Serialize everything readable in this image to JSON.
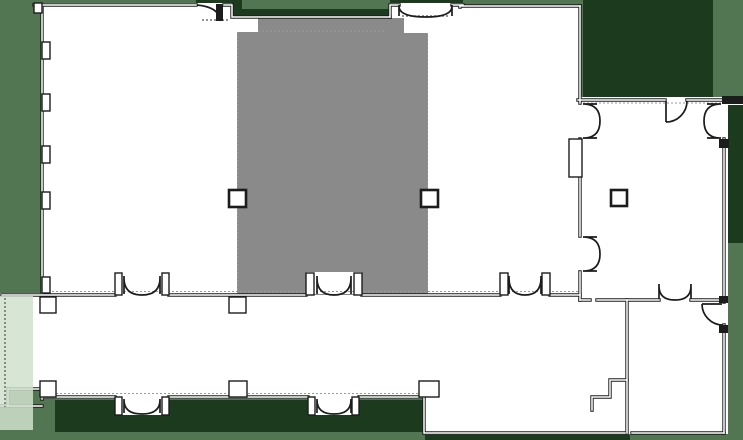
{
  "app": {
    "type": "floor-plan-view",
    "description": "Architectural floor plan with central hall highlighted in gray, door swings, columns and site shadow patches. No text labels visible."
  },
  "canvas": {
    "width": 743,
    "height": 440
  },
  "colors": {
    "background": "#527552",
    "shadow_green": "#1b3a1e",
    "interior": "#ffffff",
    "wall": "#1c1c1c",
    "hairline": "#9a9a9a",
    "highlight": "#8a8a8a",
    "cut_strip": "#cfe0cc",
    "dash": "#555555"
  },
  "shadow_patches": [
    {
      "name": "shadow-top-right-court",
      "x": 583,
      "y": 0,
      "w": 130,
      "h": 97
    },
    {
      "name": "shadow-top-left-door",
      "x": 196,
      "y": 0,
      "w": 46,
      "h": 20
    },
    {
      "name": "shadow-above-hall-wall",
      "x": 232,
      "y": 9,
      "w": 160,
      "h": 8
    },
    {
      "name": "shadow-top-entry-bay",
      "x": 390,
      "y": 0,
      "w": 73,
      "h": 5
    },
    {
      "name": "shadow-right-strip",
      "x": 728,
      "y": 97,
      "w": 15,
      "h": 146
    },
    {
      "name": "shadow-bottom-terrace",
      "x": 55,
      "y": 400,
      "w": 368,
      "h": 32
    },
    {
      "name": "shadow-bottom-right-edge",
      "x": 425,
      "y": 435,
      "w": 205,
      "h": 5
    }
  ],
  "footprint": {
    "name": "building-footprint",
    "path": "M34,3 L232,3 L232,16 L390,16 L390,3 L463,3 L463,5 L580,5 L580,97 L743,97 L743,105 L728,105 L728,434 L424,434 L424,399 L40,399 L40,389 L8,389 L8,406 L0,406 L0,293 L42,293 L42,3 Z"
  },
  "highlight_room": {
    "name": "central-hall-highlighted",
    "x": 237,
    "y": 18,
    "w": 191,
    "h": 277
  },
  "white_patches": [
    {
      "name": "hall-notch-nw",
      "x": 237,
      "y": 18,
      "w": 21,
      "h": 14
    },
    {
      "name": "hall-entry-recess-n",
      "x": 404,
      "y": 17,
      "w": 46,
      "h": 16
    },
    {
      "name": "hall-door-recess-s",
      "x": 306,
      "y": 272,
      "w": 56,
      "h": 22
    },
    {
      "name": "exterior-door-bay-sw",
      "x": 115,
      "y": 397,
      "w": 54,
      "h": 18
    },
    {
      "name": "exterior-door-bay-s",
      "x": 308,
      "y": 397,
      "w": 51,
      "h": 18
    }
  ],
  "walls": [
    {
      "name": "wall-top-west-room",
      "d": "M34,5 H196"
    },
    {
      "name": "wall-top-vestibule-step",
      "d": "M224,5 H232 V17 M232,17 H390"
    },
    {
      "name": "wall-top-entry-bay",
      "d": "M390,17 V5 H399 M452,5 H463 M460,5 V7"
    },
    {
      "name": "wall-top-middle-room",
      "d": "M460,6 H580"
    },
    {
      "name": "wall-east-main",
      "d": "M580,6 V103 M580,139 V236 M580,272 V300"
    },
    {
      "name": "wall-east-room-top",
      "d": "M578,100 H665 M687,100 H722"
    },
    {
      "name": "wall-east-room-right",
      "d": "M724,139 V302 M724,325 V433"
    },
    {
      "name": "wall-small-room-bottom",
      "d": "M632,433 H724"
    },
    {
      "name": "wall-lower-ext-bottom",
      "d": "M424,397 V433 H625"
    },
    {
      "name": "wall-corridor-bottom",
      "d": "M42,397 H115 M169,397 H308 M359,397 H424"
    },
    {
      "name": "wall-west-end-lip",
      "d": "M8,389 H40 M8,389 V406 M0,406 H42 M42,389 V399"
    },
    {
      "name": "wall-corridor-top",
      "d": "M2,295 H115 M169,295 H306 M362,295 H500 M550,295 H580"
    },
    {
      "name": "wall-east-room-bottom",
      "d": "M580,300 H590 M597,300 H659 M691,300 H724"
    },
    {
      "name": "wall-small-room-left",
      "d": "M627,300 V433"
    },
    {
      "name": "wall-step-return",
      "d": "M627,380 H610 V397 H592 V410"
    },
    {
      "name": "wall-west-room-left",
      "d": "M42,293 V5"
    }
  ],
  "hatch_lines": [
    {
      "name": "hatch-east-room-top",
      "d": "M583,103 H740"
    },
    {
      "name": "hatch-corridor-top",
      "d": "M44,291.5 H578"
    },
    {
      "name": "hatch-corridor-bottom",
      "d": "M44,393.5 H421"
    },
    {
      "name": "hatch-hall-left-edge",
      "d": "M237.5,32 V293"
    },
    {
      "name": "hatch-hall-right-edge",
      "d": "M427.5,33 V288"
    },
    {
      "name": "hatch-hall-top-seam",
      "d": "M258,31 H386"
    }
  ],
  "thresholds": [
    {
      "name": "threshold-top-left-door",
      "d": "M202,20 H228"
    },
    {
      "name": "threshold-top-entry",
      "d": "M402,16 H450"
    },
    {
      "name": "cut-line-west",
      "d": "M5,298 V407"
    }
  ],
  "pilasters": [
    {
      "name": "pilaster-west-wall-1",
      "x": 42,
      "y": 42,
      "w": 8,
      "h": 17
    },
    {
      "name": "pilaster-west-wall-2",
      "x": 42,
      "y": 94,
      "w": 8,
      "h": 17
    },
    {
      "name": "pilaster-west-wall-3",
      "x": 42,
      "y": 146,
      "w": 8,
      "h": 17
    },
    {
      "name": "pilaster-west-wall-4",
      "x": 42,
      "y": 192,
      "w": 8,
      "h": 17
    },
    {
      "name": "pilaster-west-wall-5",
      "x": 42,
      "y": 277,
      "w": 8,
      "h": 16
    },
    {
      "name": "pilaster-corr-top-1",
      "x": 40,
      "y": 297,
      "w": 16,
      "h": 16
    },
    {
      "name": "pilaster-corr-top-2",
      "x": 229,
      "y": 297,
      "w": 17,
      "h": 16
    },
    {
      "name": "pilaster-corr-bot-1",
      "x": 40,
      "y": 381,
      "w": 16,
      "h": 16
    },
    {
      "name": "pilaster-corr-bot-2",
      "x": 229,
      "y": 381,
      "w": 18,
      "h": 16
    },
    {
      "name": "pilaster-corr-bot-3",
      "x": 419,
      "y": 381,
      "w": 20,
      "h": 16
    },
    {
      "name": "pilaster-east-room",
      "x": 569,
      "y": 139,
      "w": 13,
      "h": 38
    },
    {
      "name": "jamb-corr-top-1a",
      "x": 115,
      "y": 273,
      "w": 7,
      "h": 22
    },
    {
      "name": "jamb-corr-top-1b",
      "x": 162,
      "y": 273,
      "w": 7,
      "h": 22
    },
    {
      "name": "jamb-corr-top-2a",
      "x": 306,
      "y": 273,
      "w": 8,
      "h": 22
    },
    {
      "name": "jamb-corr-top-2b",
      "x": 354,
      "y": 273,
      "w": 8,
      "h": 22
    },
    {
      "name": "jamb-corr-top-3a",
      "x": 500,
      "y": 273,
      "w": 8,
      "h": 22
    },
    {
      "name": "jamb-corr-top-3b",
      "x": 542,
      "y": 273,
      "w": 8,
      "h": 22
    },
    {
      "name": "jamb-corr-bot-1a",
      "x": 115,
      "y": 397,
      "w": 7,
      "h": 18
    },
    {
      "name": "jamb-corr-bot-1b",
      "x": 162,
      "y": 397,
      "w": 7,
      "h": 18
    },
    {
      "name": "jamb-corr-bot-2a",
      "x": 308,
      "y": 397,
      "w": 7,
      "h": 18
    },
    {
      "name": "jamb-corr-bot-2b",
      "x": 352,
      "y": 397,
      "w": 7,
      "h": 18
    },
    {
      "name": "corner-notch-nw",
      "x": 34,
      "y": 3,
      "w": 8,
      "h": 10
    }
  ],
  "blocks": [
    {
      "name": "wall-block-ne-edge",
      "x": 722,
      "y": 96,
      "w": 21,
      "h": 8
    },
    {
      "name": "jamb-block-east-door",
      "x": 719,
      "y": 139,
      "w": 10,
      "h": 9
    },
    {
      "name": "jamb-block-se-door-a",
      "x": 719,
      "y": 296,
      "w": 9,
      "h": 7
    },
    {
      "name": "jamb-block-se-door-b",
      "x": 719,
      "y": 325,
      "w": 9,
      "h": 8
    },
    {
      "name": "door-leaf-top-left",
      "x": 216,
      "y": 4,
      "w": 7,
      "h": 17
    }
  ],
  "doors": [
    {
      "name": "door-top-left-exterior",
      "d": "M197,5 Q219,7 221,21"
    },
    {
      "name": "door-top-entry-double",
      "d": "M399,5 V16 M452,5 V16 M399,7 Q400,17 426,17 M452,7 Q451,17 426,17"
    },
    {
      "name": "door-west-room-corridor",
      "d": "M124,276 V294 M160,276 V294 M124,278 Q124,295 142,295 M160,278 Q160,295 142,295"
    },
    {
      "name": "door-hall-corridor",
      "d": "M317,276 V294 M351,276 V294 M317,278 Q317,295 334,295 M351,278 Q351,295 334,295"
    },
    {
      "name": "door-middle-room-corridor",
      "d": "M509,276 V294 M541,276 V294 M509,278 Q509,295 525,295 M541,278 Q541,295 525,295"
    },
    {
      "name": "door-corridor-exterior-w",
      "d": "M124,399 V413 M160,399 V413 M124,400 Q124,414 142,414 M160,400 Q160,414 142,414"
    },
    {
      "name": "door-corridor-exterior-s",
      "d": "M317,399 V413 M351,399 V413 M317,400 Q317,414 334,414 M351,400 Q351,414 334,414"
    },
    {
      "name": "door-east-room-upper",
      "d": "M583,104 H597 M583,138 H597 M585,104 Q600,105 600,121 M585,138 Q600,137 600,121"
    },
    {
      "name": "door-east-room-lower",
      "d": "M583,237 H597 M583,271 H597 M585,237 Q600,238 600,254 M585,271 Q600,270 600,254"
    },
    {
      "name": "door-east-room-right",
      "d": "M721,104 H707 M721,138 H707 M719,104 Q704,105 704,121 M719,138 Q704,137 704,121"
    },
    {
      "name": "door-east-room-top",
      "d": "M666,101 V122 M666,122 A21,21 0 0 0 687,101"
    },
    {
      "name": "door-small-room-right",
      "d": "M702,304 H722 M702,304 A21,21 0 0 0 723,325"
    },
    {
      "name": "door-small-room-top",
      "d": "M659,284 V299 M691,284 V299 M659,286 Q659,300 675,300 M691,286 Q691,300 675,300"
    }
  ],
  "columns": [
    {
      "name": "column-hall-west",
      "x": 229,
      "y": 190,
      "s": 17
    },
    {
      "name": "column-hall-east",
      "x": 421,
      "y": 190,
      "s": 17
    },
    {
      "name": "column-east-room",
      "x": 611,
      "y": 190,
      "s": 16
    }
  ],
  "cut_overlay": {
    "name": "corridor-cut-fade",
    "x": 0,
    "y": 296,
    "w": 33,
    "h": 134
  }
}
